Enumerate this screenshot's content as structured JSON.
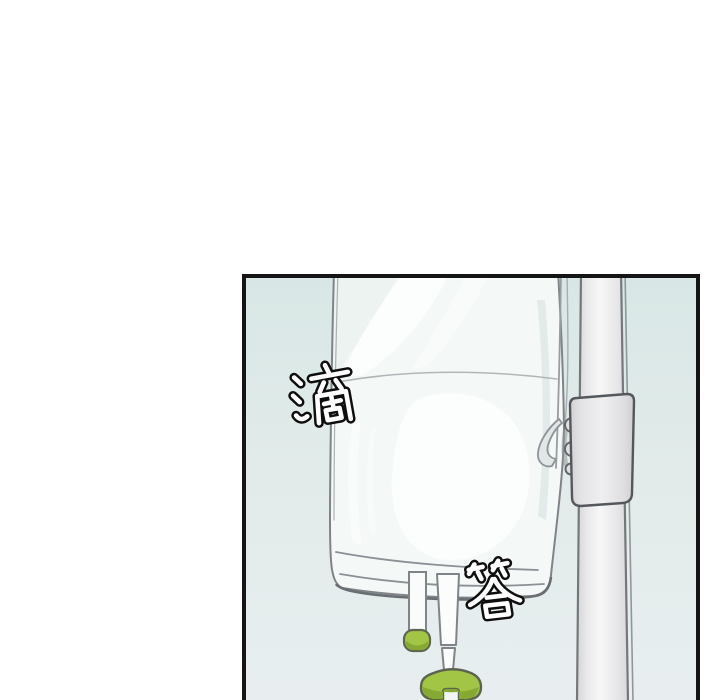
{
  "scene": {
    "kind": "webtoon-comic-panel",
    "description": "A translucent IV drip bag hanging on a metal IV pole inside a bordered comic panel with a pale blue-green gradient background; drip-drop sound effects are drawn over the art.",
    "sfx": [
      {
        "char": "滴"
      },
      {
        "char": "答"
      }
    ],
    "colors": {
      "page_background": "#ffffff",
      "panel_border": "#151515",
      "panel_background_top": "#d8e7e6",
      "panel_background_bottom": "#e8eef0",
      "bag_fill": "#f4f8f7",
      "outline_gray": "#7f8488",
      "pole_fill": "#ededef",
      "accent_green": "#a2c545",
      "accent_green_dark": "#86a933"
    },
    "objects": [
      "iv-bag",
      "liquid-level-line",
      "iv-pole",
      "pole-clamp",
      "hanger-tab",
      "injection-port-with-green-cap",
      "drip-tube",
      "green-roller-clamp"
    ]
  }
}
